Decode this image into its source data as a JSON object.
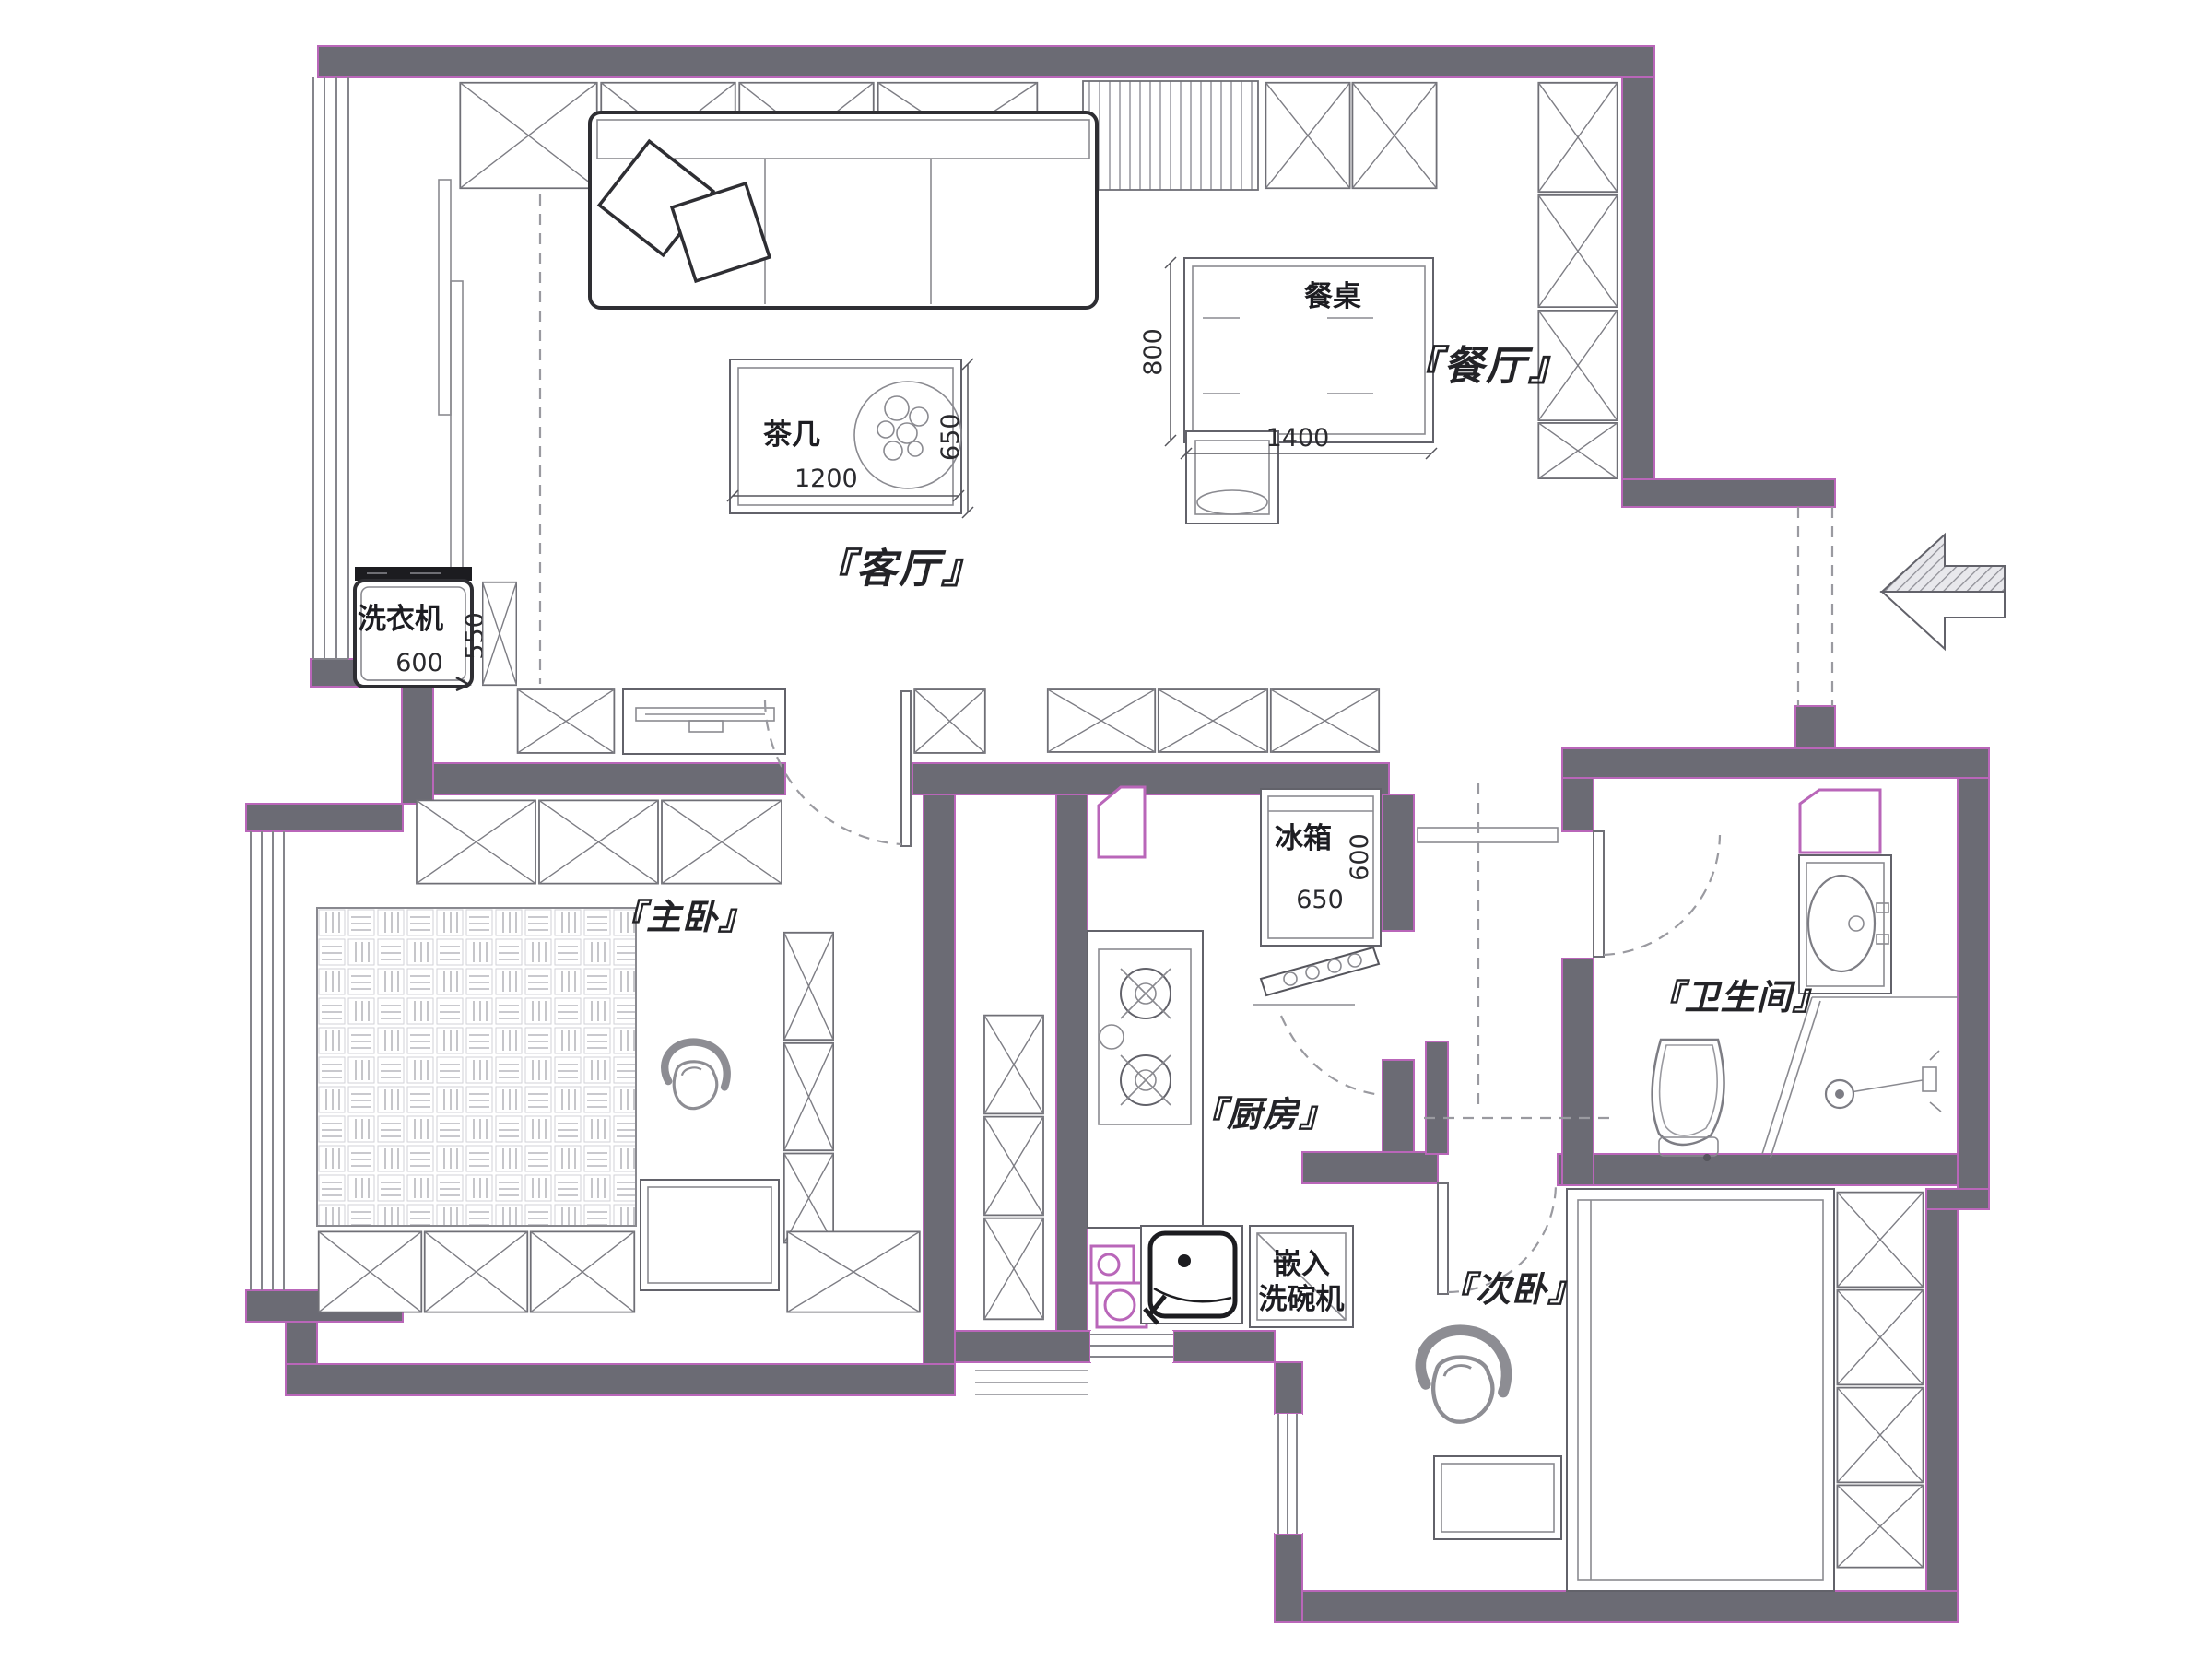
{
  "plan": {
    "type": "apartment-floor-plan",
    "colors": {
      "wall": "#6b6b74",
      "wall_outline": "#b966b9",
      "linework": "#62626a",
      "background": "#ffffff"
    }
  },
  "rooms": {
    "living_room": {
      "label": "『客厅』"
    },
    "dining_room": {
      "label": "『餐厅』"
    },
    "master_bedroom": {
      "label": "『主卧』"
    },
    "kitchen": {
      "label": "『厨房』"
    },
    "bathroom": {
      "label": "『卫生间』"
    },
    "second_bedroom": {
      "label": "『次卧』"
    }
  },
  "fixtures": {
    "coffee_table": {
      "label": "茶几",
      "dim_width": "1200",
      "dim_depth": "650"
    },
    "dining_table": {
      "label": "餐桌",
      "dim_width": "1400",
      "dim_depth": "800"
    },
    "washing_machine": {
      "label": "洗衣机",
      "dim_width": "600",
      "dim_depth": "550"
    },
    "fridge": {
      "label": "冰箱",
      "dim_width": "650",
      "dim_depth": "600"
    },
    "dishwasher": {
      "label_line1": "嵌入",
      "label_line2": "洗碗机"
    }
  },
  "icons": {
    "entry_arrow": "block-arrow-left"
  }
}
